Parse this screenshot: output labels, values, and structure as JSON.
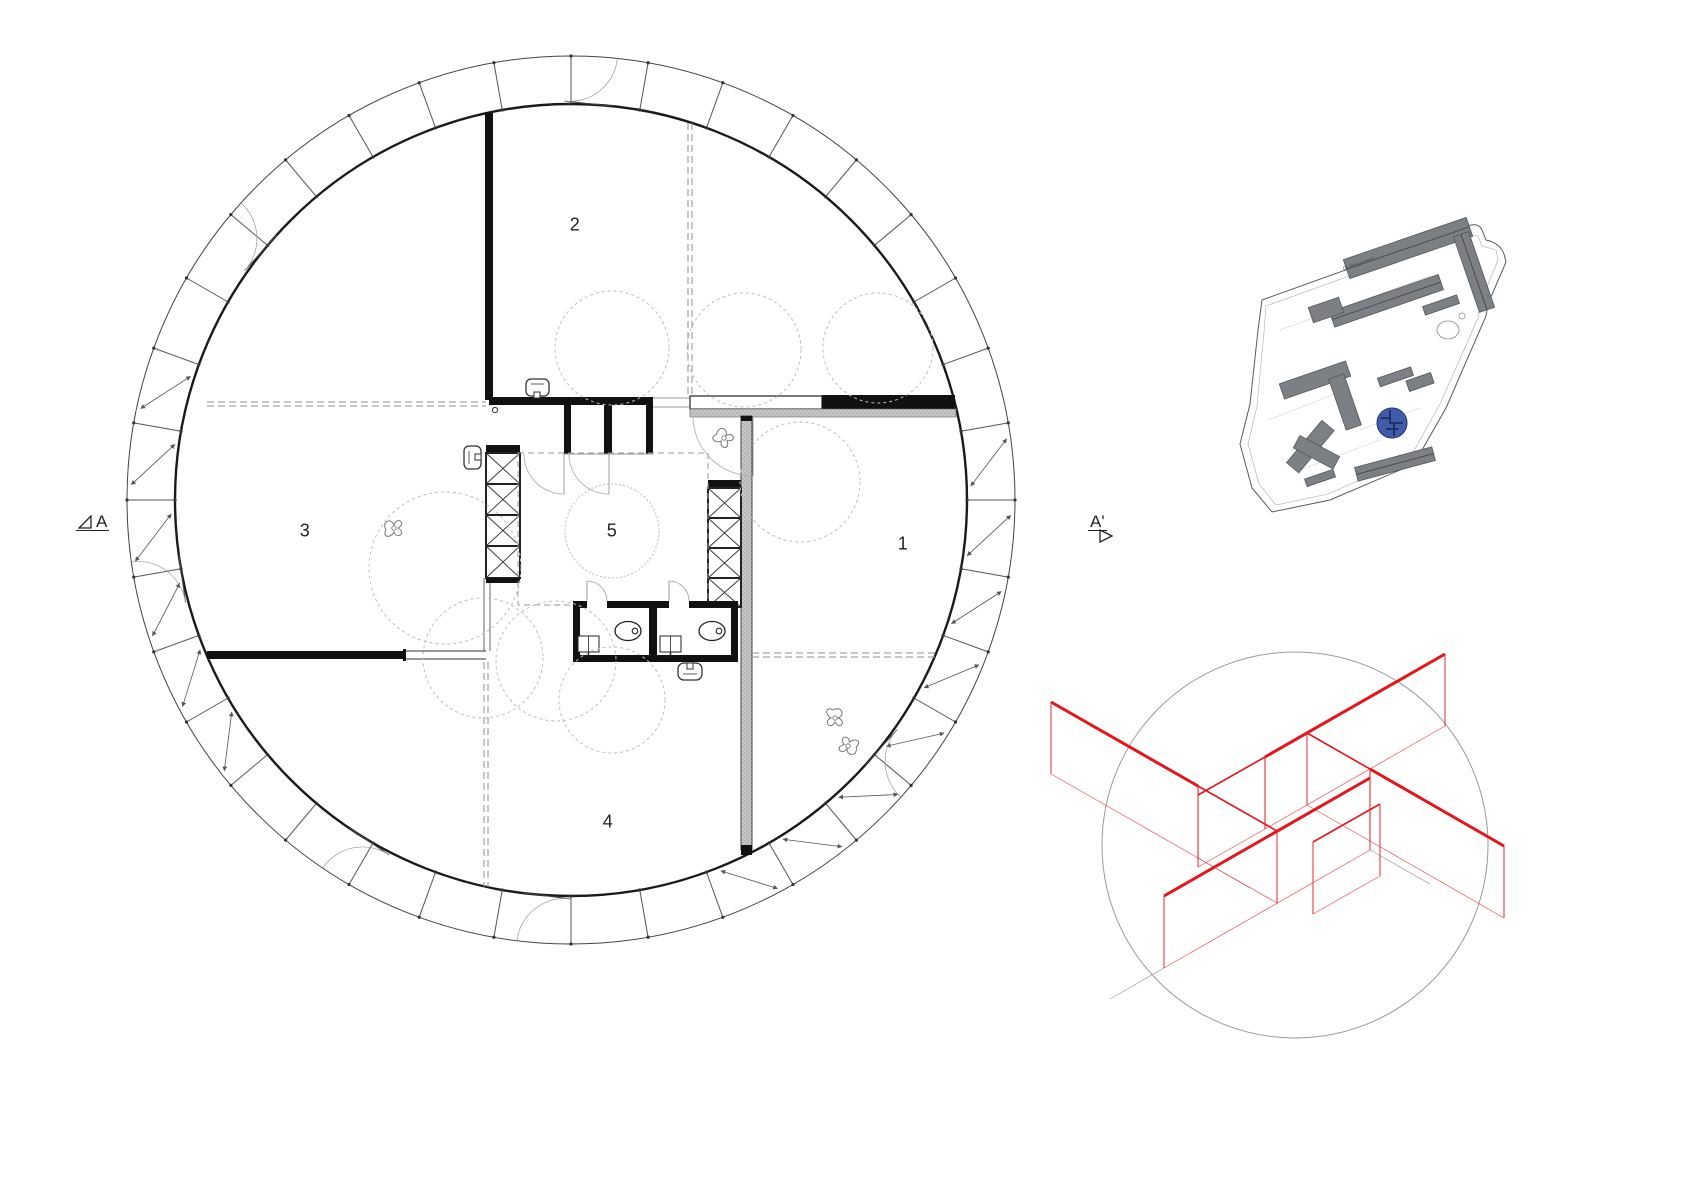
{
  "floor_plan": {
    "room_labels": {
      "r1": "1",
      "r2": "2",
      "r3": "3",
      "r4": "4",
      "r5": "5"
    },
    "section_markers": {
      "left": "A",
      "right": "A'"
    },
    "colors": {
      "wall": "#1a1a1a",
      "line": "#555555",
      "dashed": "#8f8f8f",
      "hatch": "#c6c6c6",
      "play_circle": "#bdbdbd"
    }
  },
  "site_plan": {
    "street_label": "De Naeyerstraat",
    "colors": {
      "building": "#7c7f84",
      "building_edge": "#54575b",
      "boundary": "#5a5a5a",
      "highlight": "#3f5ba9"
    }
  },
  "axon_diagram": {
    "colors": {
      "wall": "#e4151b",
      "outline": "#9a9a9a"
    }
  }
}
